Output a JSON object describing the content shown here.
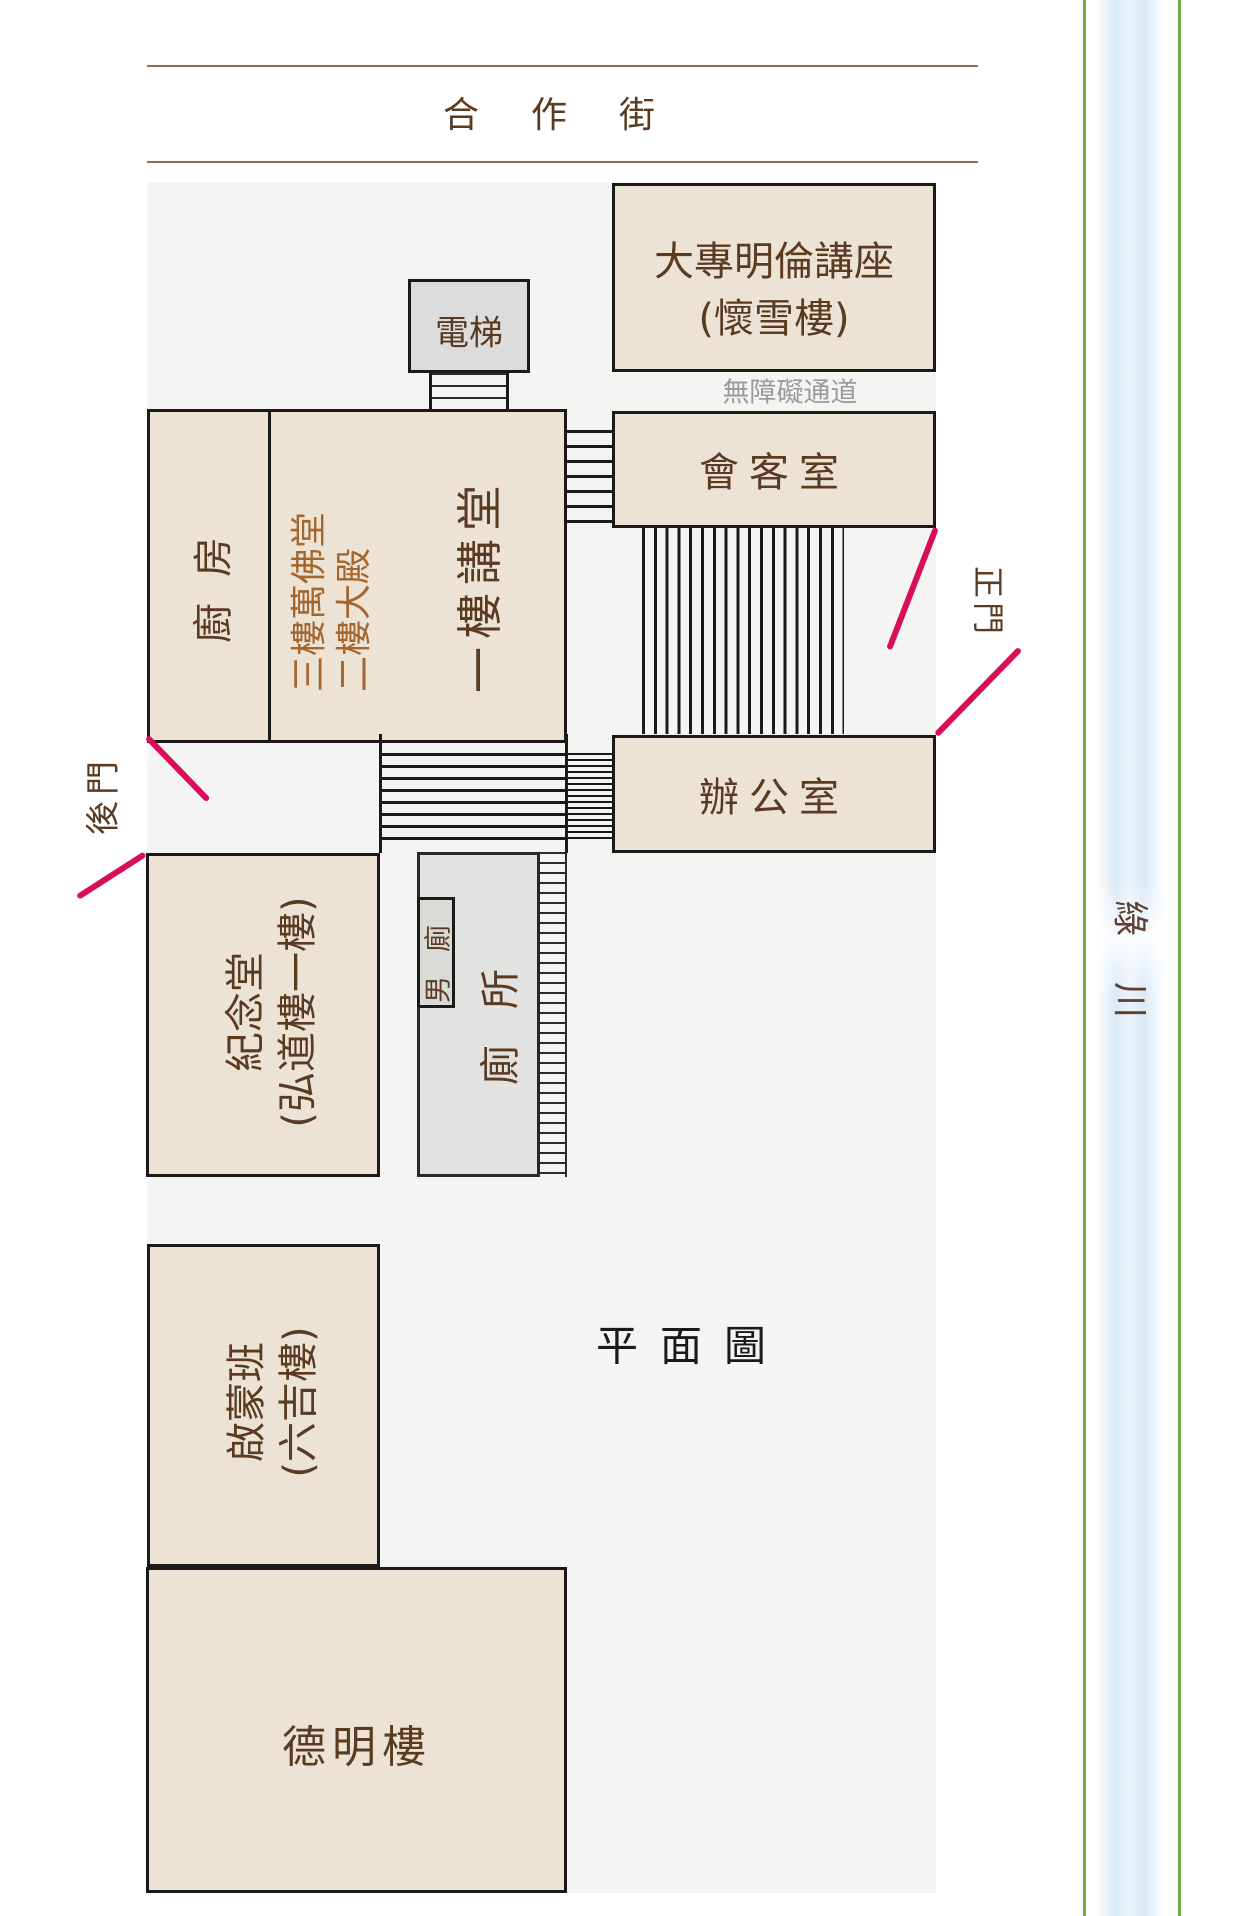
{
  "title": "平面圖",
  "street": {
    "name": "合作街"
  },
  "river": {
    "name": "綠川"
  },
  "gates": {
    "main": "正門",
    "back": "後門"
  },
  "labels": {
    "accessible_path": "無障礙通道"
  },
  "rooms": {
    "lecture_tower": {
      "line1": "大專明倫講座",
      "line2": "(懷雪樓)"
    },
    "reception": "會客室",
    "office": "辦公室",
    "elevator": "電梯",
    "kitchen": "廚房",
    "upper_floors": {
      "line1": "三樓萬佛堂",
      "line2": "二樓大殿"
    },
    "first_floor_hall": "一樓講堂",
    "memorial_hall": {
      "line1": "紀念堂",
      "line2": "(弘道樓一樓)"
    },
    "toilet": "廁所",
    "mens_toilet": "男廁",
    "enlightenment_class": {
      "line1": "啟蒙班",
      "line2": "(六吉樓)"
    },
    "deming_building": "德明樓"
  },
  "colors": {
    "building_fill": "#ece3d5",
    "map_ground": "#f4f4f2",
    "gate_stroke": "#d80e5a",
    "river_line": "#72b043",
    "river_water": "#d9e9f6",
    "text_brown": "#5a3b22",
    "text_orange_brown": "#a4662e",
    "text_gray": "#9a9a9a",
    "street_line": "#8c6d58"
  }
}
